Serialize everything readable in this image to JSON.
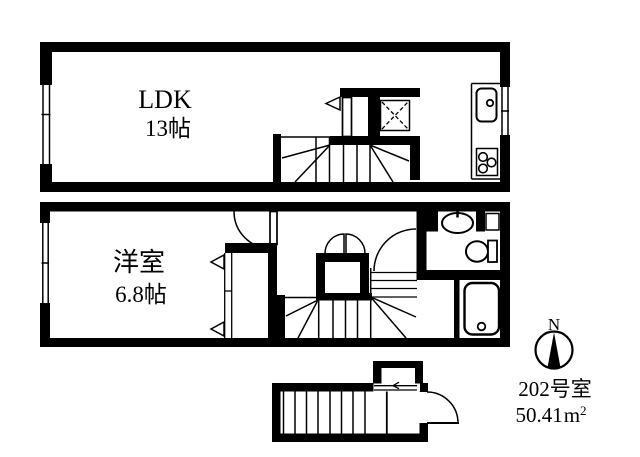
{
  "colors": {
    "ink": "#000000",
    "paper": "#ffffff"
  },
  "upper_floor": {
    "name": "LDK",
    "size": "13帖"
  },
  "lower_floor": {
    "name": "洋室",
    "size": "6.8帖"
  },
  "compass": {
    "north_label": "N"
  },
  "unit_info": {
    "room_number": "202号室",
    "area_value": "50.41",
    "area_unit": "m",
    "area_exponent": "2"
  }
}
